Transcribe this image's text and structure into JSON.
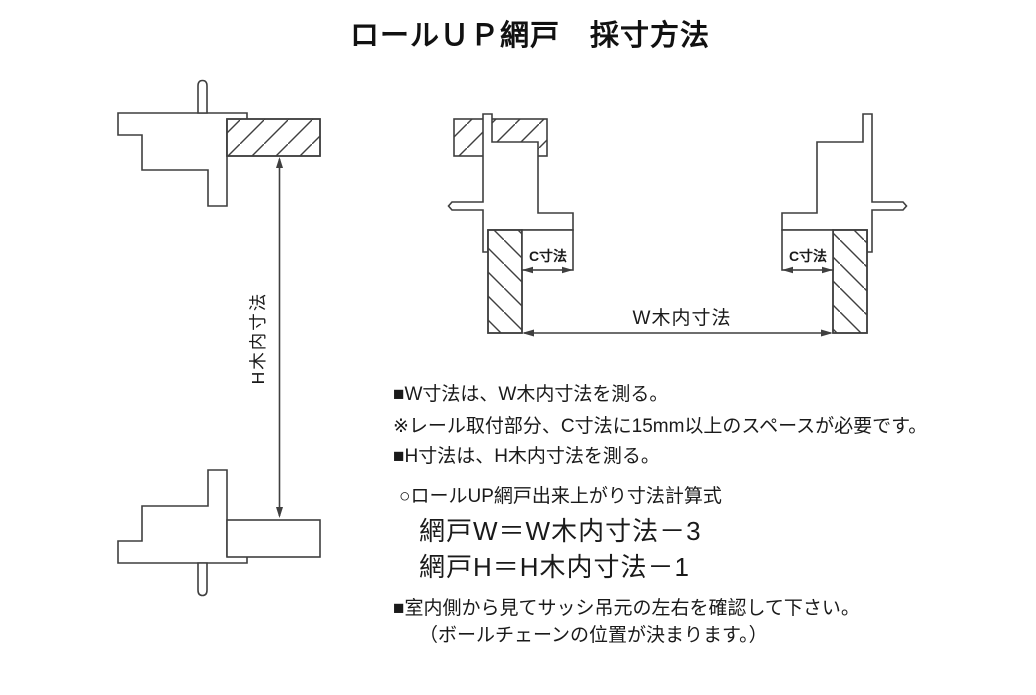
{
  "title": "ロールＵＰ網戸　採寸方法",
  "ink_color": "#3f3f3f",
  "text_color": "#1a1a1a",
  "labels": {
    "h_dim": "H木内寸法",
    "w_dim": "W木内寸法",
    "c_left": "C寸法",
    "c_right": "C寸法"
  },
  "notes": {
    "items": [
      {
        "text": "■W寸法は、W木内寸法を測る。"
      },
      {
        "text": "※レール取付部分、C寸法に15mm以上のスペースが必要です。"
      },
      {
        "text": "■H寸法は、H木内寸法を測る。"
      },
      {
        "text": "○ロールUP網戸出来上がり寸法計算式"
      },
      {
        "text": "網戸W＝W木内寸法－3"
      },
      {
        "text": "網戸H＝H木内寸法－1"
      },
      {
        "text": "■室内側から見てサッシ吊元の左右を確認して下さい。"
      },
      {
        "text": "（ボールチェーンの位置が決まります。）"
      }
    ]
  }
}
